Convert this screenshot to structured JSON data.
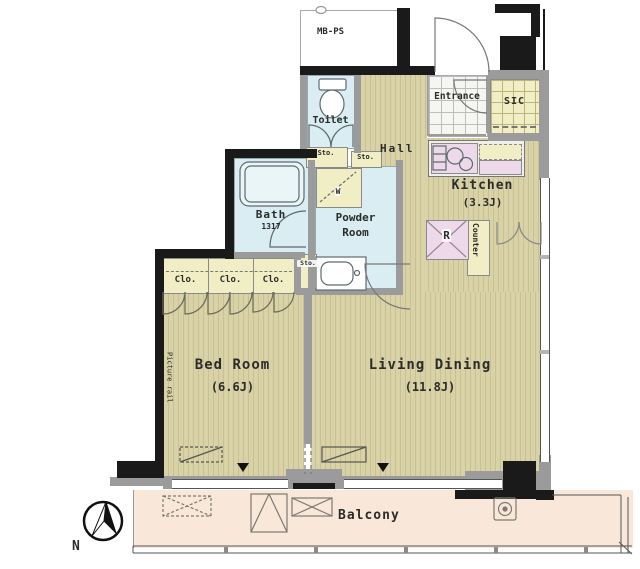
{
  "labels": {
    "mb_ps": "MB-PS",
    "toilet": "Toilet",
    "sto_toilet": "Sto.",
    "sto_hall": "Sto.",
    "sto_powder": "Sto.",
    "hall": "Hall",
    "entrance": "Entrance",
    "sic": "SIC",
    "kitchen": "Kitchen",
    "kitchen_size": "(3.3J)",
    "refrigerator": "R",
    "counter": "Counter",
    "bath": "Bath",
    "bath_size": "1317",
    "powder_line1": "Powder",
    "powder_line2": "Room",
    "washer": "W",
    "clo_1": "Clo.",
    "clo_2": "Clo.",
    "clo_3": "Clo.",
    "bedroom": "Bed Room",
    "bedroom_size": "(6.6J)",
    "living": "Living Dining",
    "living_size": "(11.8J)",
    "balcony": "Balcony",
    "picture_rail": "Picture rail",
    "north": "N"
  },
  "colors": {
    "wall": "#1a1a1a",
    "wall_gray": "#9b9b9b",
    "floor": "#d9d2a6",
    "floor_stripe": "#c9c195",
    "wet_area": "#d9edf2",
    "closet_yellow": "#f1edc4",
    "fixture_pink": "#eed9ea",
    "balcony": "#f9e8d9"
  }
}
